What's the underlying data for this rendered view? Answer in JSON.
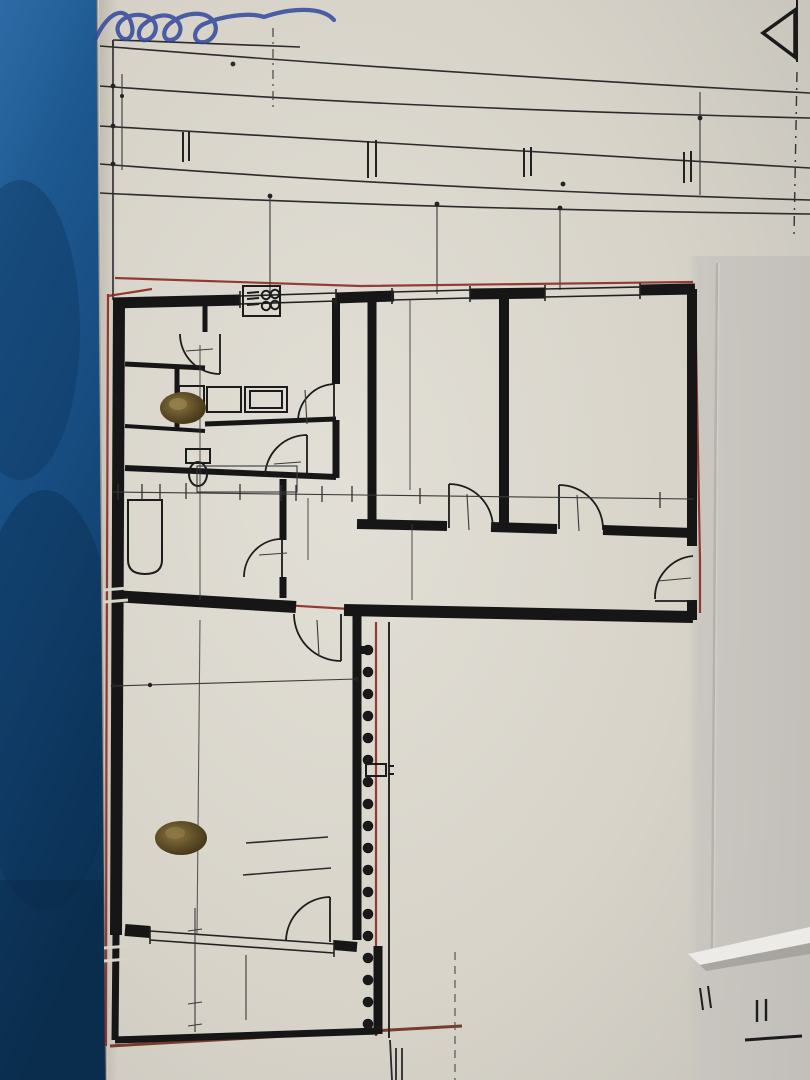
{
  "photo": {
    "handwriting": "…sse",
    "pencil_mark": "-1°"
  },
  "marker": {
    "label": "A"
  },
  "top_dims": {
    "d5680": "56.80",
    "d2a": "2",
    "d1170": "11.70",
    "d220": "2.20",
    "d93": "93",
    "d7a": "7",
    "d360": "3.60",
    "d25a": "25",
    "d300a": "3.00",
    "d7b": "7",
    "d343": "3.43",
    "d25b": "25",
    "d335a": "3.35",
    "d2b": "2",
    "d300b": "3.00",
    "d339a": "3.39",
    "d339b": "3.39",
    "d192": "1.92",
    "d315": "3.15",
    "d335b": "3.35",
    "v125": "125",
    "v145": "145"
  },
  "rooms": {
    "ar1": {
      "label": "AR.",
      "size": "2.32"
    },
    "ar2": {
      "label": "AR",
      "size": "Ø 2.00"
    },
    "kueche": {
      "label": "KÜCHE",
      "area": "9.00 M2"
    },
    "zimmer1": {
      "label": "ZIMMER",
      "area": "14.10 M2"
    },
    "zimmer2": {
      "label": "ZIMMER",
      "area": "16.12 M2"
    },
    "wc": {
      "label": "WC",
      "width": "2.74",
      "depth": "83",
      "shaft": "AS 15/20"
    },
    "bad": {
      "label": "BAD",
      "area": "7.98 M2"
    },
    "vorraum": {
      "label": "VORRAUM",
      "area": "15.69 M2"
    },
    "zimmer3": {
      "label": "ZIMMER",
      "area": "25.81 M2"
    },
    "loggia": {
      "label": "LOGGIA",
      "area": "5.65 M2"
    },
    "total": "98.91 M2"
  },
  "doors": {
    "ar": {
      "w": "70",
      "h": "200"
    },
    "kueche": {
      "w": "70",
      "h": "200"
    },
    "wc": {
      "w": "60",
      "h": "200"
    },
    "bad": {
      "w": "70",
      "h": "200"
    },
    "zimmer1": {
      "w": "80",
      "h": "200"
    },
    "zimmer2": {
      "w": "80",
      "h": "200"
    },
    "zimmer3": {
      "w": "80",
      "h": "200"
    },
    "entrance": {
      "w": "85",
      "h": "200"
    }
  },
  "dims": {
    "k35": "35",
    "k250": "2.50",
    "row45": "45",
    "row7a": "7",
    "row7b": "7",
    "row241": "2.41",
    "row7c": "7",
    "row155": "1.55",
    "row675": "6.75",
    "row25": "25",
    "b268": "2.68",
    "b368": "3.68",
    "z135": "35",
    "z1470": "4.70",
    "v7": "7",
    "v148": "1.48",
    "z325": "25",
    "z320": "20",
    "z3445": "4.45",
    "z340": "40",
    "z3580": "5.80",
    "e": "E",
    "one": "1",
    "s3": "3",
    "s4": "4",
    "s5": "5",
    "s6": "6",
    "s7": "7",
    "lg35": "35",
    "lg127": "1.27",
    "lg8": "8",
    "lg276": "2.76",
    "lg145": "145÷242"
  },
  "colors": {
    "survey_red": "#8b2a22",
    "paper": "#d9d5cb",
    "blue_backdrop": "#1a528a",
    "ink": "#1d1d1d",
    "handwriting_blue": "#31479c"
  }
}
